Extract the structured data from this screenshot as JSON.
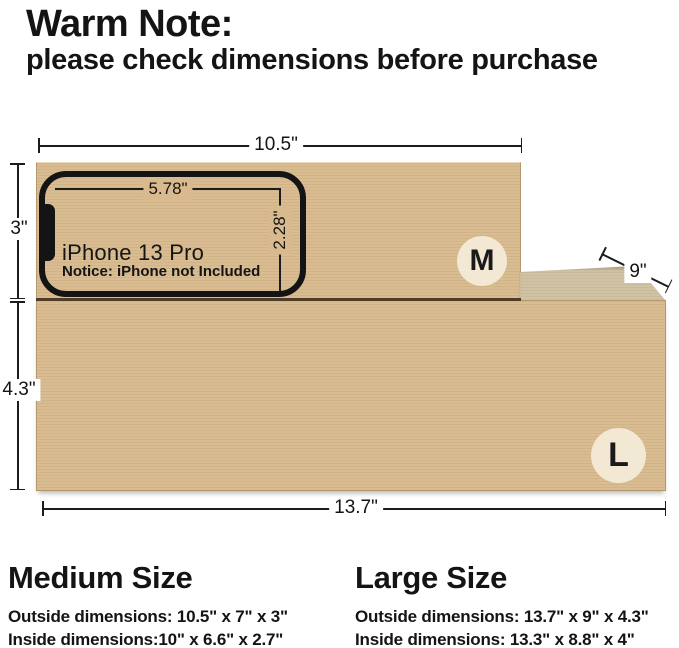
{
  "header": {
    "title": "Warm Note:",
    "subtitle": "please check dimensions before purchase"
  },
  "diagram": {
    "medium_box": {
      "badge": "M",
      "width_label": "10.5\"",
      "height_label": "3\""
    },
    "large_box": {
      "badge": "L",
      "width_label": "13.7\"",
      "height_label": "4.3\"",
      "depth_label": "9\""
    },
    "phone": {
      "width_label": "5.78\"",
      "height_label": "2.28\"",
      "model": "iPhone 13 Pro",
      "notice": "Notice: iPhone not Included"
    }
  },
  "size_details": {
    "medium": {
      "heading": "Medium Size",
      "outside": "Outside dimensions: 10.5\" x 7\" x 3\"",
      "inside": "Inside dimensions:10\" x 6.6\" x 2.7\""
    },
    "large": {
      "heading": "Large Size",
      "outside": "Outside dimensions: 13.7\" x 9\" x 4.3\"",
      "inside": "Inside dimensions: 13.3\" x 8.8\" x 4\""
    }
  },
  "colors": {
    "cardboard_front": "#d8ba8e",
    "cardboard_top": "#cfc0a2",
    "badge_bg": "#f2e8d4",
    "line": "#1c1c1c",
    "background": "#ffffff"
  }
}
